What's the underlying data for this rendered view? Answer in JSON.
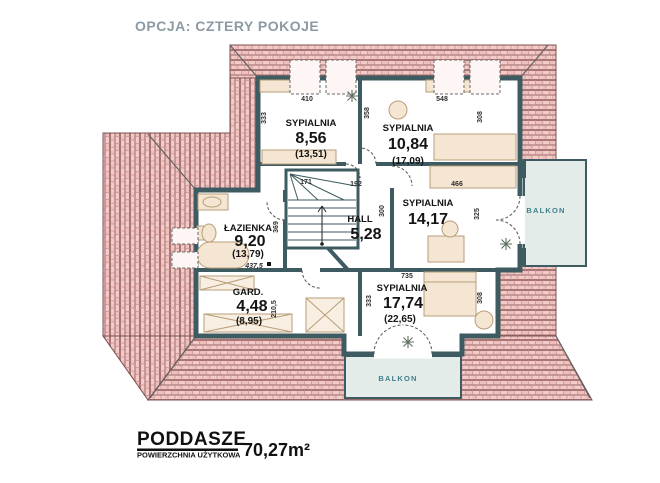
{
  "title": "OPCJA: CZTERY POKOJE",
  "rooms": {
    "bedroom1": {
      "name": "SYPIALNIA",
      "area": "8,56",
      "gross": "(13,51)"
    },
    "bedroom2": {
      "name": "SYPIALNIA",
      "area": "10,84",
      "gross": "(17,09)"
    },
    "bedroom3": {
      "name": "SYPIALNIA",
      "area": "14,17"
    },
    "bedroom4": {
      "name": "SYPIALNIA",
      "area": "17,74",
      "gross": "(22,65)"
    },
    "bathroom": {
      "name": "ŁAZIENKA",
      "area": "9,20",
      "gross": "(13,79)"
    },
    "hall": {
      "name": "HALL",
      "area": "5,28"
    },
    "wardrobe": {
      "name": "GARD.",
      "area": "4,48",
      "gross": "(8,95)"
    }
  },
  "balconies": {
    "right": "BALKON",
    "bottom": "BALKON"
  },
  "dimensions": {
    "bedroom1_width": "410",
    "bedroom1_depth": "333",
    "divider_wall": "358",
    "bedroom2_width": "548",
    "bedroom2_depth": "308",
    "corridor_width": "192",
    "bedroom3_width": "466",
    "hall_depth": "300",
    "bedroom3_depth": "325",
    "bathroom_depth": "369",
    "stairs_width": "171",
    "wardrobe_depth": "210,5",
    "bedroom4_width": "735",
    "bedroom4_depth_left": "333",
    "bedroom4_depth_right": "308",
    "floor_level": "437,5"
  },
  "footer": {
    "level_name": "PODDASZE",
    "area_label": "POWIERZCHNIA UŻYTKOWA",
    "area_value": "70,27m²"
  },
  "colors": {
    "title": "#8b9aa4",
    "walls": "#3d5b60",
    "roof_tile": "#f3cbc8",
    "roof_line": "#b97c7c",
    "balcony_label": "#41808e",
    "balcony_floor": "#e3ece8",
    "furniture": "#f4e6d2",
    "text": "#1a1a1a"
  }
}
